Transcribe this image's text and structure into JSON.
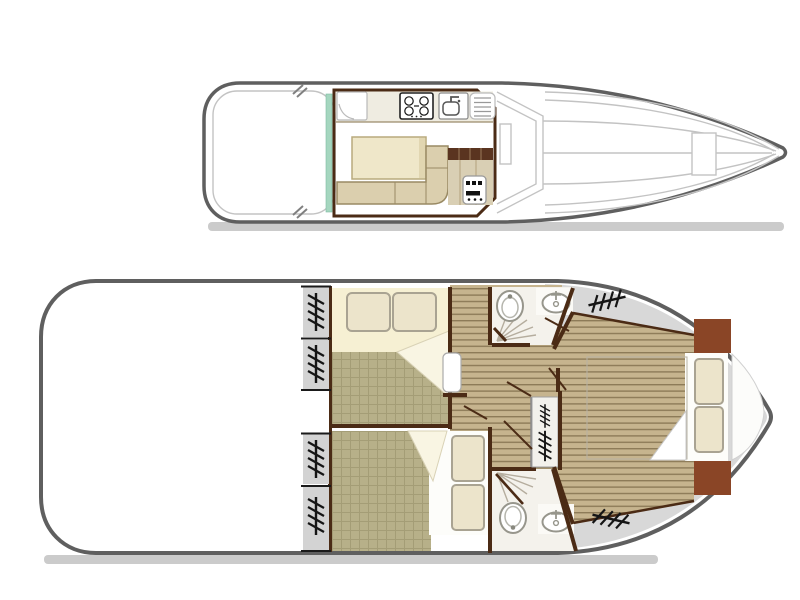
{
  "document": {
    "type": "boat-deck-floor-plan",
    "views": [
      "upper-deck-top-view",
      "lower-deck-accommodation-plan"
    ]
  },
  "colors": {
    "hull_outline": "#5f5f5f",
    "hull_fill": "#ffffff",
    "shadow": "#c2c2c2",
    "deck_gray": "#d8d8d8",
    "detail_gray": "#c3c3c3",
    "wall_brown": "#4b2b15",
    "wood_base": "#c6b48e",
    "wood_line": "#8d7b58",
    "duvet_base": "#b7b089",
    "duvet_line": "#a49d76",
    "mattress_base": "#dcd7cc",
    "mattress_line": "#cbc6bb",
    "sheet_cream": "#f6f0d3",
    "pillow_beige": "#ece4cb",
    "pillow_outline": "#a9a392",
    "fold_cream": "#f9f5e3",
    "bench_beige": "#dbcfae",
    "bench_outline": "#998a64",
    "table_beige": "#efe7c9",
    "counter_white": "#efece1",
    "cabinet_beige": "#d9cfb4",
    "stair_brown": "#5a3420",
    "headboard_brown": "#8a4526",
    "room_white": "#f4f2ec",
    "fixture_outline": "#97968c",
    "teal_strip": "#a5d6bf",
    "icon_black": "#151515",
    "shower_line": "#b5ad9e"
  },
  "upper_deck": {
    "features": [
      "aft-open-deck",
      "saloon",
      "galley-counter",
      "fridge",
      "gas-stove",
      "galley-sink",
      "draining-board",
      "dinette-table",
      "l-shaped-bench",
      "helm-console",
      "steps-down",
      "sliding-door-strip",
      "windshield",
      "foredeck",
      "bow-hatch",
      "mooring-cleats"
    ]
  },
  "lower_deck": {
    "features": [
      "aft-open-deck",
      "bow-side-cabin-double-bed",
      "aft-side-cabin-double-bed",
      "corridor",
      "cabin-door",
      "shower-room-fore",
      "shower-room-aft",
      "toilet",
      "washbasin",
      "shower",
      "companionway-stairs",
      "master-cabin-double-bed",
      "headboard",
      "bow-seat",
      "opening-windows"
    ]
  },
  "icons": {
    "toilet": "oval-bowl-with-seat",
    "washbasin": "oval-basin-with-tap",
    "shower": "radiating-spray-lines",
    "stove": "four-burner-grid",
    "sink": "basin-with-l-tap",
    "drainer": "parallel-lines",
    "window": "hatched-ladder-mark",
    "stairs": "hatched-ladder-mark",
    "cleat": "double-diagonal-mark"
  }
}
